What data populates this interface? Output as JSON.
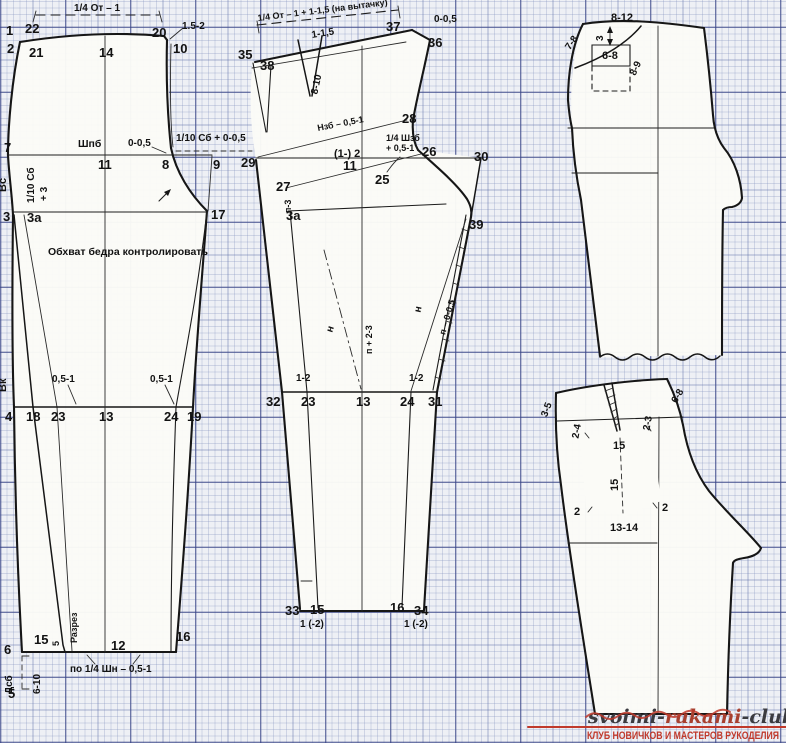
{
  "colors": {
    "ink": "#161616",
    "paper": "#fbfbf7",
    "grid_major": "#343e80",
    "red": "#c0392b"
  },
  "front": {
    "dim_waist": "1/4 От – 1",
    "p1": "1",
    "p22": "22",
    "p20": "20",
    "inc152": "1.5-2",
    "p2": "2",
    "p21": "21",
    "p14": "14",
    "p10": "10",
    "shpb": "Шпб",
    "z005": "0-0,5",
    "sb005": "1/10 Сб + 0-0,5",
    "p7": "7",
    "p11": "11",
    "p8": "8",
    "p9": "9",
    "vs": "Вс",
    "sb": "1/10 Сб",
    "plus3": "+ 3",
    "p3": "3",
    "p3a": "3а",
    "p17": "17",
    "hip_note": "Обхват бедра контролировать",
    "vk": "Вк",
    "k05l": "0,5-1",
    "k05r": "0,5-1",
    "p4": "4",
    "p18": "18",
    "p23": "23",
    "p13": "13",
    "p24": "24",
    "p19": "19",
    "p15": "15",
    "cut5": "5",
    "razrez": "Разрез",
    "p12": "12",
    "p16": "16",
    "p6": "6",
    "dsb": "Дсб",
    "r610": "6-10",
    "p5": "5",
    "hem_note": "по 1/4 Шн – 0,5-1"
  },
  "back": {
    "dim_waist": "1/4 От – 1 + 1-1,5 (на вытачку)",
    "d115": "1-1,5",
    "p37": "37",
    "z005": "0-0,5",
    "p36": "36",
    "p35": "35",
    "p38": "38",
    "dart": "8-10",
    "p29": "29",
    "nzb": "Нзб – 0,5-1",
    "p28": "28",
    "m2": "(1-) 2",
    "p11": "11",
    "p25": "25",
    "shzb1": "1/4 Шзб",
    "shzb2": "+ 0,5-1",
    "p26": "26",
    "p30": "30",
    "p27": "27",
    "pn3": "п-3",
    "p3a": "3а",
    "p39": "39",
    "n1": "н",
    "p23v": "п + 2-3",
    "n2": "н",
    "p005": "п – 0-0,5",
    "k12l": "1-2",
    "k12r": "1-2",
    "p32": "32",
    "p23": "23",
    "p13": "13",
    "p24": "24",
    "p31": "31",
    "p33": "33",
    "p15": "15",
    "p16": "16",
    "p34": "34",
    "h12l": "1 (-2)",
    "h12r": "1 (-2)"
  },
  "upper_right": {
    "d812": "8-12",
    "d78": "7-8",
    "d3": "3",
    "d68": "6-8",
    "d89": "8-9"
  },
  "lower_right": {
    "d35": "3-5",
    "d68": "6-8",
    "d24": "2-4",
    "d23": "2-3",
    "p15t": "15",
    "p15m": "15",
    "p2l": "2",
    "p2r": "2",
    "d1314": "13-14"
  },
  "watermark": {
    "site_a": "svoimi-",
    "site_b": "rukami",
    "site_c": "-club.ru",
    "caption": "КЛУБ НОВИЧКОВ И МАСТЕРОВ РУКОДЕЛИЯ"
  }
}
